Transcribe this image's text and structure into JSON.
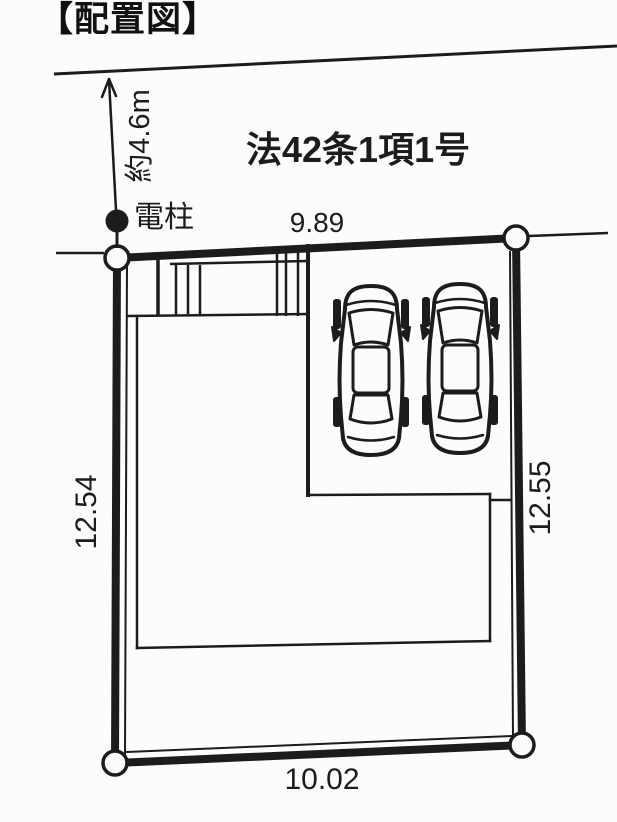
{
  "title": "【配置図】",
  "road": {
    "classification_label": "法42条1項1号",
    "width_label": "約4.6m",
    "utility_pole_label": "電柱"
  },
  "plot": {
    "dim_top": "9.89",
    "dim_left": "12.54",
    "dim_right": "12.55",
    "dim_bottom": "10.02"
  },
  "colors": {
    "ink": "#1c1c1c",
    "paper": "#fcfcfb"
  }
}
